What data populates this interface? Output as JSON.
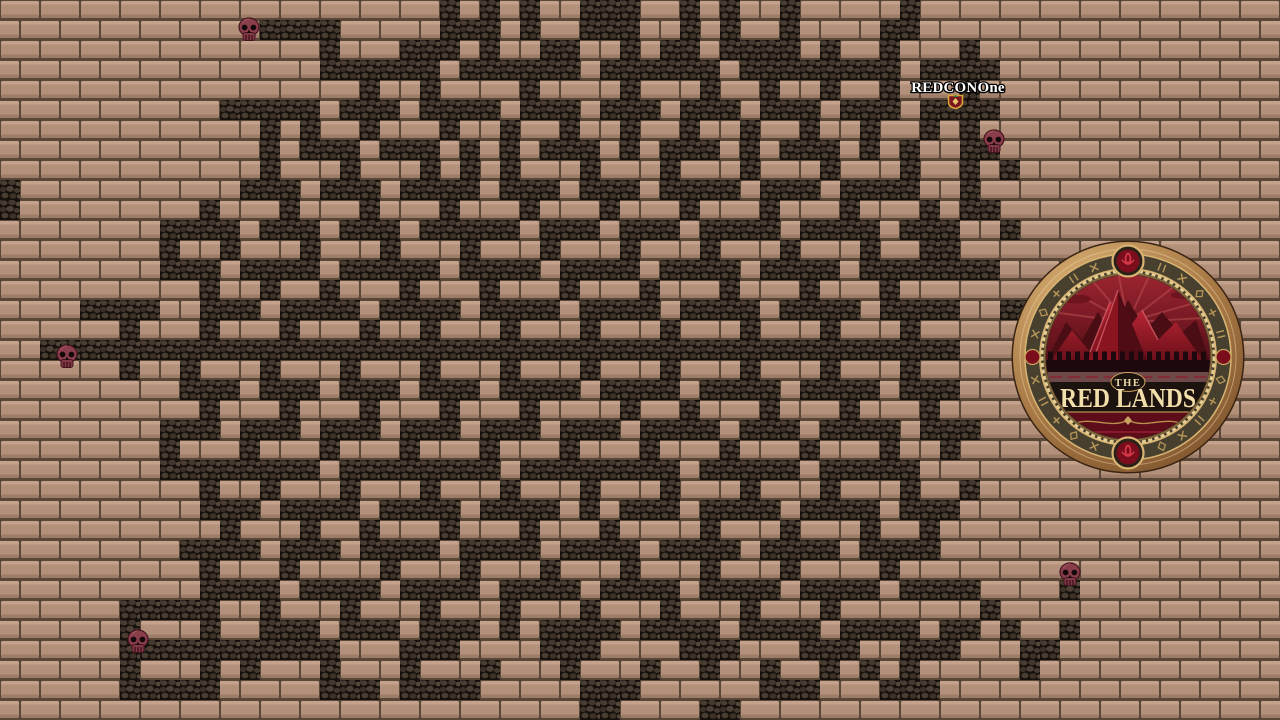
{
  "game": {
    "player_label": "REDCONOne",
    "logo": {
      "top_word": "THE",
      "main_words": "RED LANDS"
    }
  },
  "colors": {
    "brick_face": "#b2907a",
    "brick_highlight": "#c4a28b",
    "brick_shadow": "#9d7d68",
    "mortar": "#5a4636",
    "path_base": "#16100c",
    "path_stone": "#4a3e33",
    "skull": "#8a3d4a",
    "label_text": "#ffffff",
    "logo_bronze": "#a97a46",
    "logo_band": "#47402e",
    "logo_gold": "#c9a35f",
    "logo_gem_red": "#7a0e1c",
    "logo_mountain_red": "#b02030",
    "logo_text_cream": "#f0deab"
  },
  "maze": {
    "cell_size": 20,
    "cols": 64,
    "rows": 36,
    "legend": {
      "#": "dark-cobble-path",
      ".": "brick-wall"
    },
    "grid": [
      "......................#.#.#..###..#.#..#.....#..................",
      ".............####.....###.#..###..#.#..#....##..................",
      "................#...###.#..##..#.##.####.#..#...#...............",
      "................######.######.######.########.####...............",
      "..................#..#....#....#...#..#..#..#...#...............",
      "...........#####.###.####.###.###.###.###.###.####....err.......",
      ".............#.#..#...#..#..#..#..#..#..#..#..#.#...............",
      ".............#.###.###.#.#.###.#.###.#.###.#.#..##..............",
      ".............#...#...#.#.#...#...#...#...#...#..#.#.............",
      "#...........###.###.####.###.###.####.###.####..#...............",
      "#.........#...#...#...#...#...#...#...#...#...#.##..............",
      "........####.###.###.#####.###.###.####.####.###..#.............",
      "........#..#...#...#...#...#...#...#...#...#..##................",
      "........###.####.#####.####.####.####.####.#######..............",
      "..........#..#..#...#...#...#...#...#...#...#...................",
      "....####..###.####.####.####.####.####.####.####..##............",
      "......#...#...#...#..#...#...#...#...#...#...#..................",
      "..##############################################................",
      "......#..#...#...#...#...#...#...#...#...#...#..................",
      ".........###.###.###.###.####.####.####.####.###................",
      "..........#...#...#...#...#....#..#...#...#...#.................",
      "........###.###.###.###.###.###.####.###.####.###...............",
      "........#...#...#...#...#...#...#...#...#...#..#................",
      "........########.########.########.#####.#####..................",
      "..........#..#...#...#...#...#...#...#...#...#..#...............",
      "..........###.####.####.####.#.###.####.####.###................",
      "...........#...#..#...#...#...#....#...#...#..#.................",
      ".........####.###.####.####.####.####.####.####.................",
      "..........#...#....#...#...#...#...#...#....#...................",
      "..........####.####.####.####.####.####.####.####....#..........",
      "......#####..#...#...#...#...#...#...#...#.......#..............",
      "......#...#..###.###.###.#.####.####.####.####.##.#..#..........",
      "......###########...###....###....###...###..###...##...........",
      "......#...#.#...#...#...#...#...#..#..#..#.#.#.....#............",
      "......#####.....###.####.....###......###...###.................",
      ".............................##....##..........................."
    ]
  },
  "skulls": [
    {
      "x": 237,
      "y": 17
    },
    {
      "x": 982,
      "y": 129
    },
    {
      "x": 55,
      "y": 344
    },
    {
      "x": 1058,
      "y": 562
    },
    {
      "x": 126,
      "y": 629
    }
  ],
  "player_marker": {
    "x": 947,
    "y": 94
  },
  "label_pos": {
    "x": 958,
    "y": 92
  },
  "logo_geometry": {
    "cx": 1128,
    "cy": 357,
    "outer_r": 115
  },
  "runes": {
    "count": 26,
    "radius": 95.5
  }
}
